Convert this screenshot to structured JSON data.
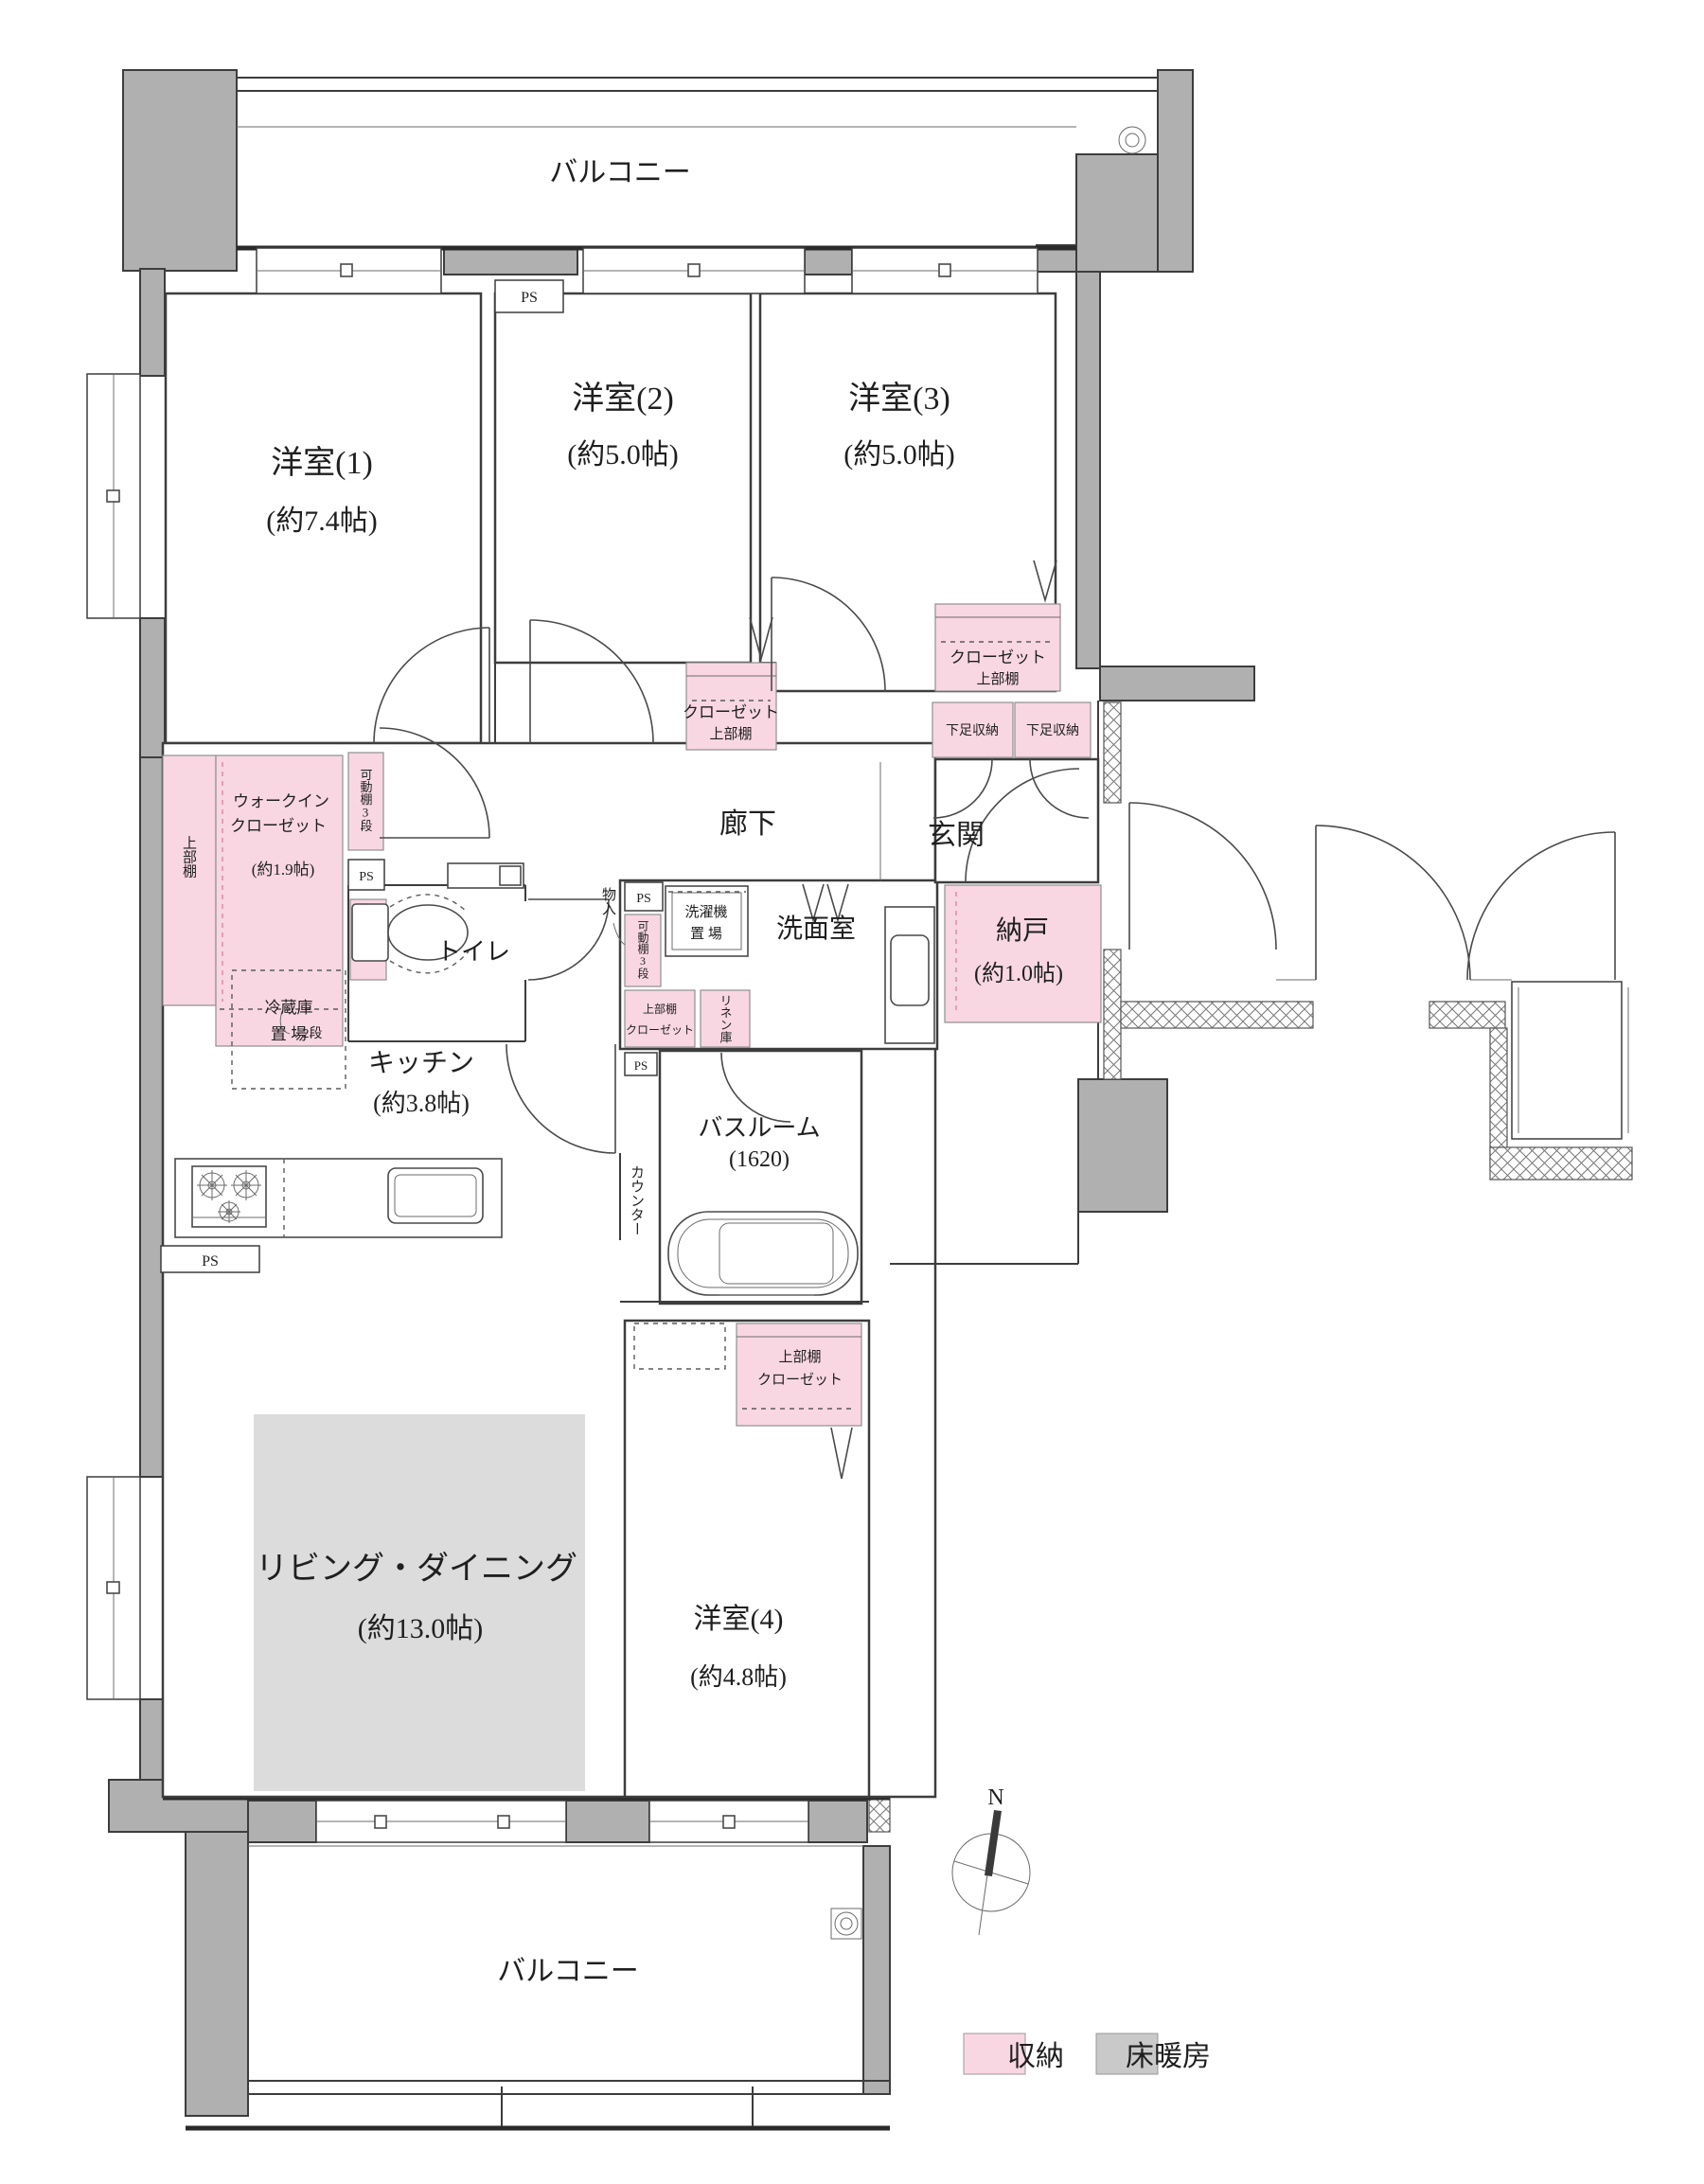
{
  "plan": {
    "balcony_label": "バルコニー",
    "rooms": {
      "w1": {
        "name": "洋室(1)",
        "size": "(約7.4帖)"
      },
      "w2": {
        "name": "洋室(2)",
        "size": "(約5.0帖)"
      },
      "w3": {
        "name": "洋室(3)",
        "size": "(約5.0帖)"
      },
      "w4": {
        "name": "洋室(4)",
        "size": "(約4.8帖)"
      },
      "ld": {
        "name": "リビング・ダイニング",
        "size": "(約13.0帖)"
      },
      "kitchen": {
        "name": "キッチン",
        "size": "(約3.8帖)"
      },
      "wic": {
        "line1": "ウォークイン",
        "line2": "クローゼット",
        "size": "(約1.9帖)"
      },
      "nando": {
        "name": "納戸",
        "size": "(約1.0帖)"
      },
      "bath": {
        "name": "バスルーム",
        "size": "(1620)"
      },
      "washroom": "洗面室",
      "toilet": "トイレ",
      "hall": "廊下",
      "entrance": "玄関",
      "disaster": {
        "name": "防災倉庫",
        "type": "(Aタイプ)"
      }
    },
    "storage": {
      "closet": "クローゼット",
      "upper_shelf": "上部棚",
      "shoe_box": "下足収納",
      "movable_shelf": "可動棚3段",
      "two_tier": "2段",
      "linen": "リネン庫",
      "storage_in": "物入"
    },
    "fixtures": {
      "ps": "PS",
      "washer_line1": "洗濯機",
      "washer_line2": "置 場",
      "fridge_line1": "冷蔵庫",
      "fridge_line2": "置 場",
      "counter": "カウンター"
    },
    "legend": {
      "storage": "収納",
      "floor_heating": "床暖房"
    },
    "compass": {
      "north": "N"
    },
    "colors": {
      "storage_pink": "#f8d7e2",
      "floor_heating_gray": "#c9c9c9",
      "wall_gray": "#b0b0b0"
    }
  }
}
